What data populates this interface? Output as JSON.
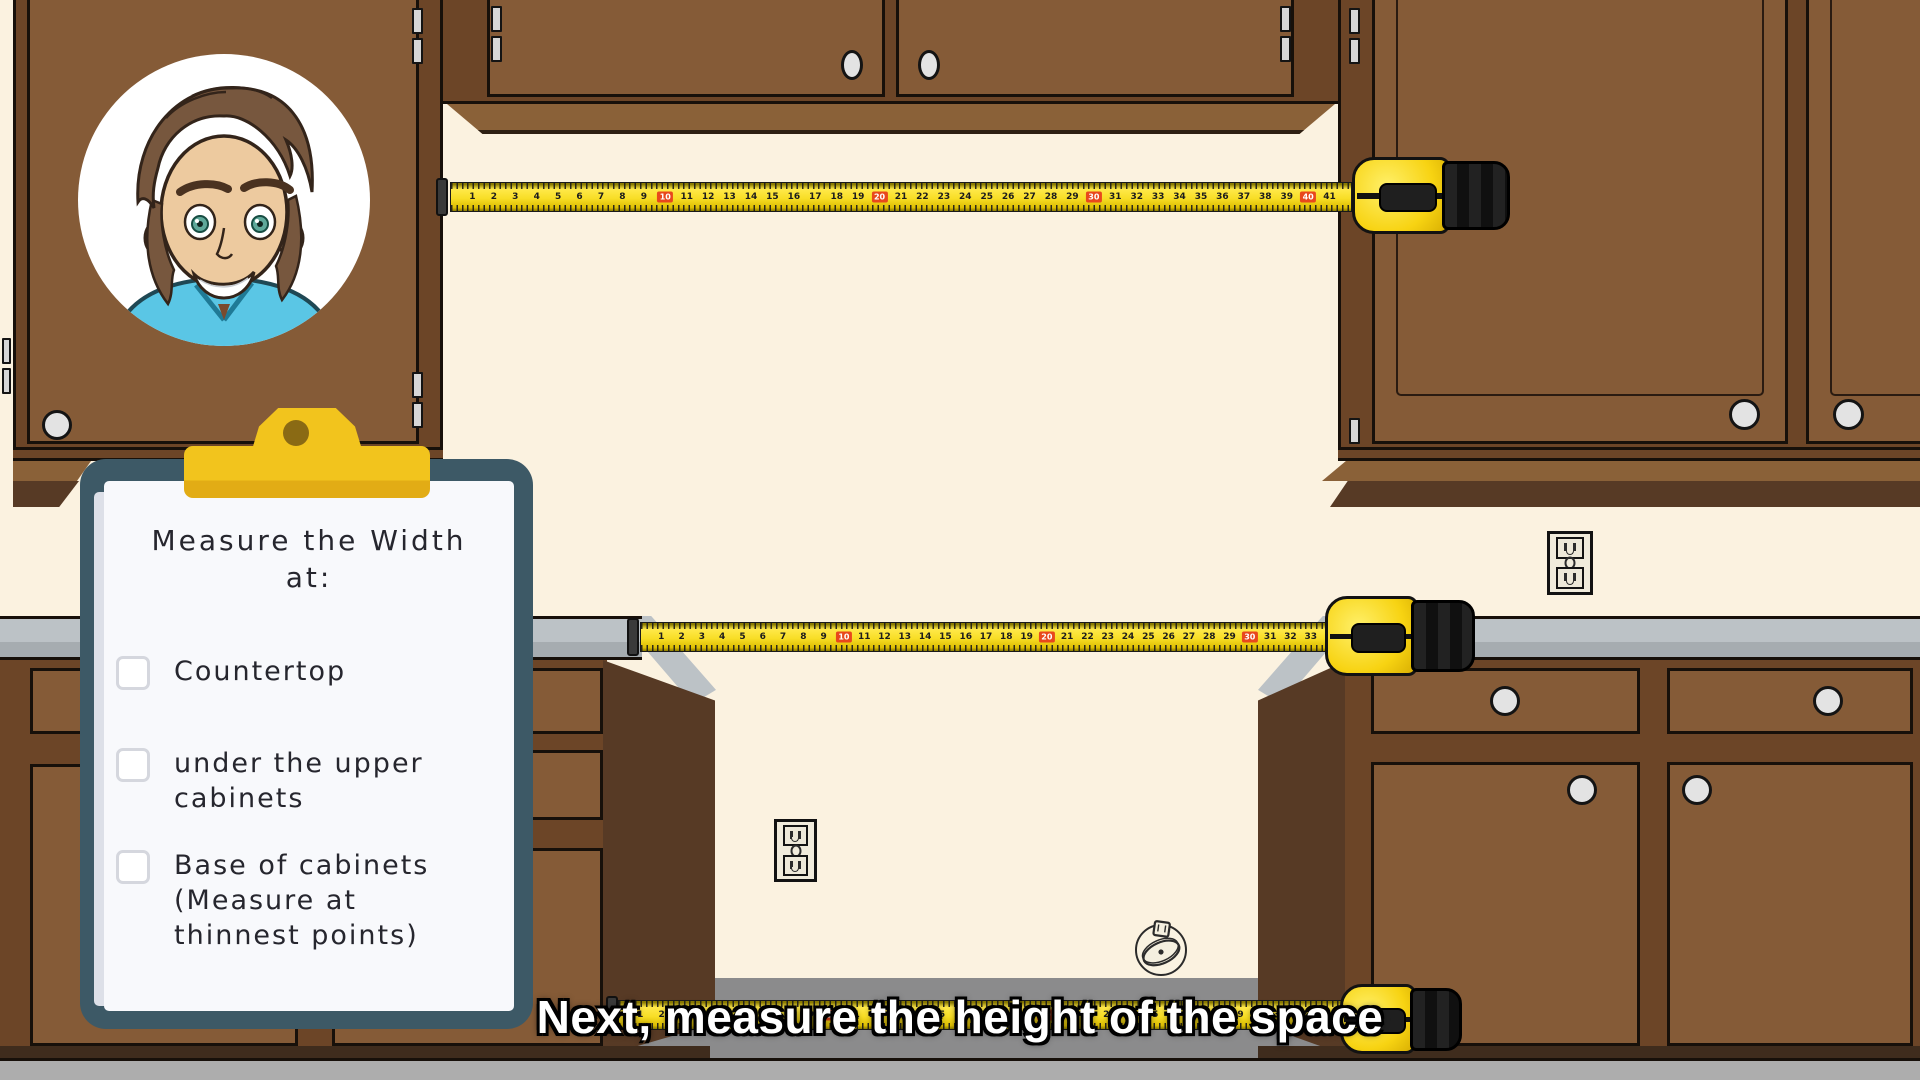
{
  "caption": {
    "text": "Next, measure the height of the space"
  },
  "clipboard": {
    "title_lines": [
      "Measure the Width",
      "at:"
    ],
    "items": [
      {
        "lines": [
          "Countertop"
        ],
        "checked": false
      },
      {
        "lines": [
          "under the upper",
          "cabinets"
        ],
        "checked": false
      },
      {
        "lines": [
          "Base of cabinets",
          "(Measure at",
          "thinnest points)"
        ],
        "checked": false
      }
    ]
  },
  "tapes": {
    "top": {
      "from": 1,
      "to": 41,
      "red_every": 10
    },
    "middle": {
      "from": 1,
      "to": 33,
      "red_every": 10
    },
    "bottom": {
      "from": 1,
      "to": 33,
      "red_every": 10
    }
  },
  "icons": {
    "presenter": "presenter-avatar",
    "ornament": "dish-ornament-icon",
    "outlets": "power-outlet"
  },
  "colors": {
    "wall": "#FBF2E0",
    "cab_frame": "#6C4527",
    "cab_door": "#855B37",
    "cab_dark": "#573A25",
    "molding": "#8A6138",
    "toe": "#3F2C1D",
    "counter_light": "#BCC2C6",
    "counter_dark": "#A6ACB0",
    "floor": "#ADADAD",
    "recess": "#8B8B8C",
    "tape_yellow": "#F6D71A",
    "clip_yellow": "#F2C41D",
    "board": "#3D5966",
    "paper": "#F8F9FC",
    "red_marker": "#E8481C",
    "shirt": "#5AC6E5",
    "skin": "#EDCA9F",
    "hair": "#77573E",
    "knob": "#E3E3E3",
    "outline": "#17100A"
  }
}
